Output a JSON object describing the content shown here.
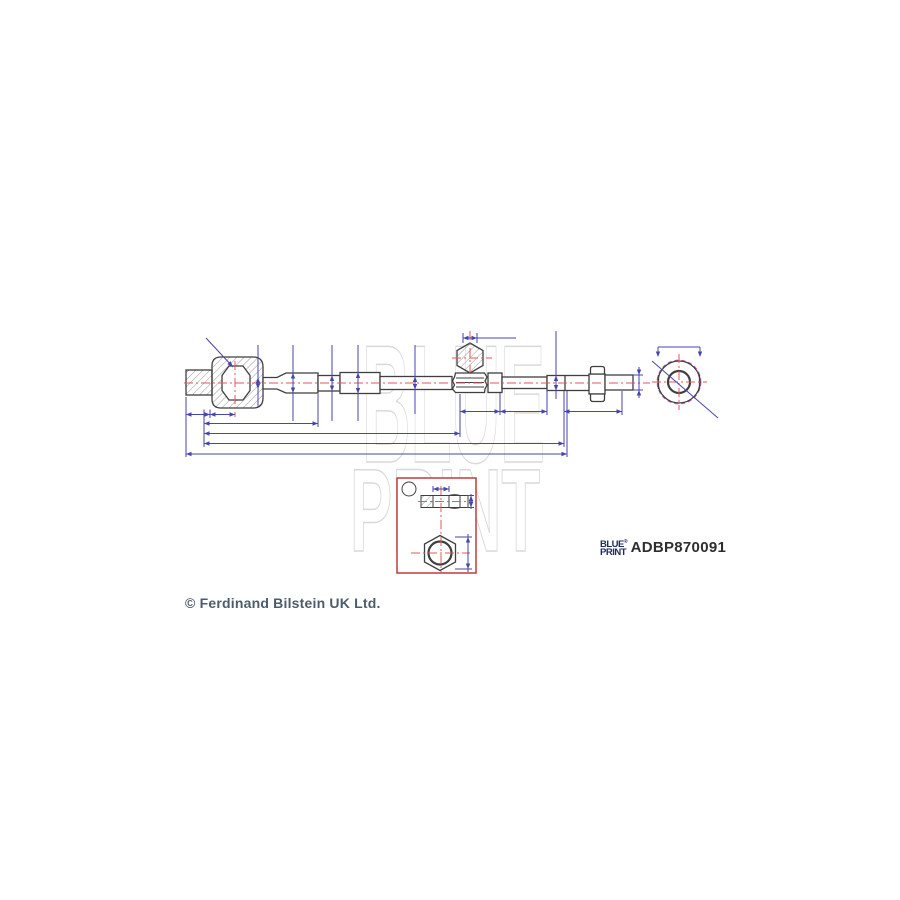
{
  "product": {
    "part_number": "ADBP870091",
    "brand": {
      "line1": "BLUE",
      "reg": "®",
      "line2": "PRINT"
    },
    "copyright": "© Ferdinand Bilstein UK Ltd."
  },
  "watermark": {
    "line1": "BLUE",
    "line2": "PRINT"
  },
  "colors": {
    "outline": "#3f3f3f",
    "dimension": "#4646ad",
    "centerline": "#e05a5a",
    "detail_box": "#c23b3b",
    "thread_dashed": "#c857b8",
    "hatch": "#9a9aa0",
    "watermark": "#d9d9d9",
    "logo": "#1f2a66",
    "part_number": "#2e2e31",
    "copyright": "#4d5c6c"
  }
}
